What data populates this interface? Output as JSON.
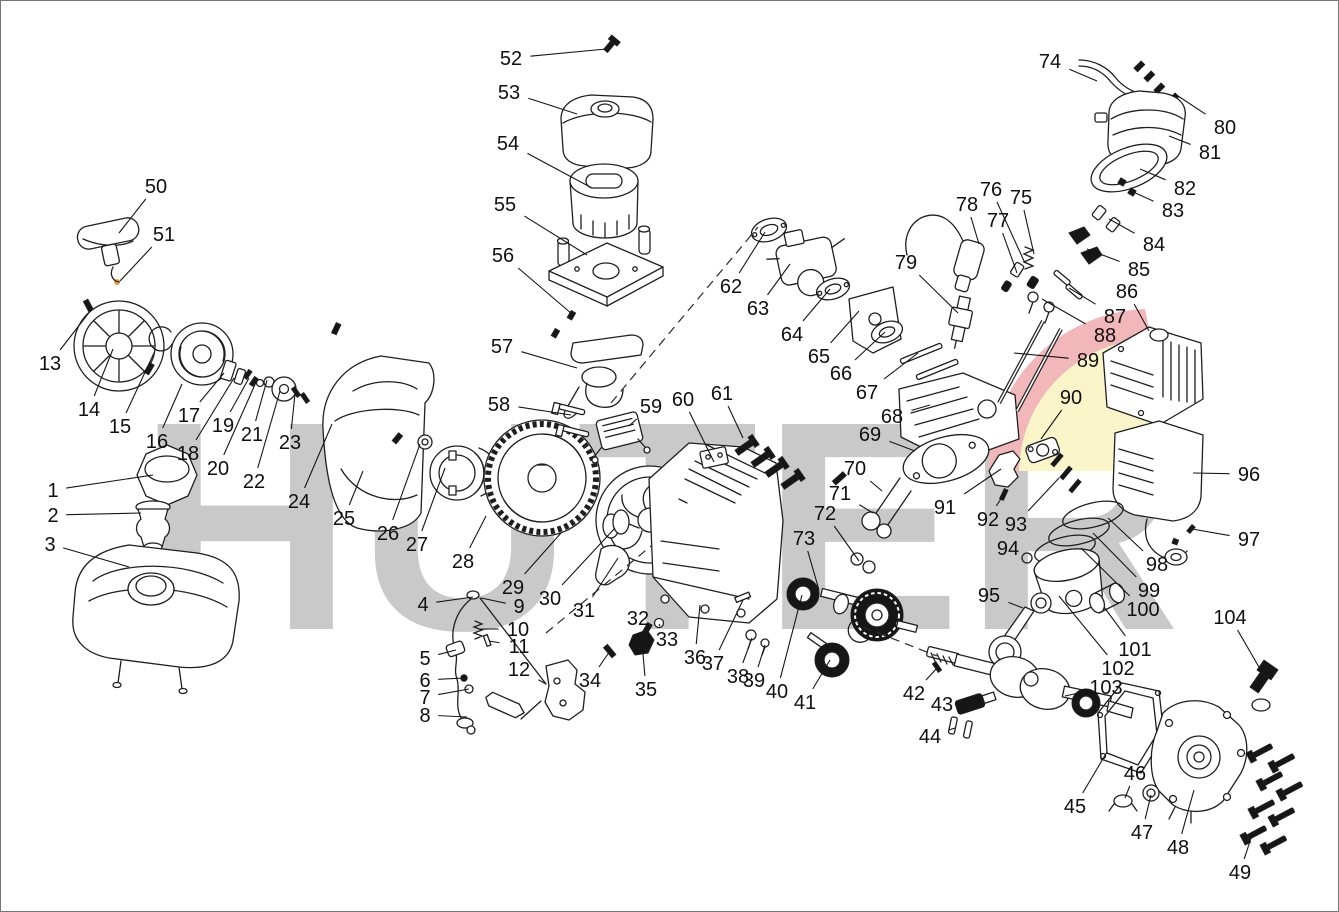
{
  "diagram": {
    "type": "exploded-parts-diagram",
    "subject": "gasoline-engine",
    "canvas": {
      "width": 1339,
      "height": 912
    },
    "watermark": {
      "text": "HUTER",
      "gray_color": "#c9c9c9",
      "red_color": "#f2b7b9",
      "yellow_color": "#faf5c9",
      "accent_dot_color": "#e8a33d"
    },
    "label_color": "#101010",
    "part_count": 104,
    "dashed_axes": [
      {
        "x1": 610,
        "y1": 402,
        "x2": 757,
        "y2": 226
      },
      {
        "x1": 545,
        "y1": 632,
        "x2": 650,
        "y2": 545
      },
      {
        "x1": 862,
        "y1": 626,
        "x2": 936,
        "y2": 655
      }
    ],
    "parts": [
      {
        "n": "1",
        "x": 52,
        "y": 489,
        "ex": 152,
        "ey": 474
      },
      {
        "n": "2",
        "x": 52,
        "y": 514,
        "ex": 140,
        "ey": 512
      },
      {
        "n": "3",
        "x": 49,
        "y": 543,
        "ex": 128,
        "ey": 566
      },
      {
        "n": "4",
        "x": 422,
        "y": 603,
        "ex": 472,
        "ey": 596
      },
      {
        "n": "5",
        "x": 424,
        "y": 657,
        "ex": 455,
        "ey": 649
      },
      {
        "n": "6",
        "x": 424,
        "y": 679,
        "ex": 463,
        "ey": 677
      },
      {
        "n": "7",
        "x": 424,
        "y": 696,
        "ex": 468,
        "ey": 688
      },
      {
        "n": "8",
        "x": 424,
        "y": 714,
        "ex": 466,
        "ey": 716
      },
      {
        "n": "9",
        "x": 518,
        "y": 605,
        "ex": 480,
        "ey": 597
      },
      {
        "n": "10",
        "x": 517,
        "y": 628,
        "ex": 478,
        "ey": 628
      },
      {
        "n": "11",
        "x": 518,
        "y": 645,
        "ex": 488,
        "ey": 640
      },
      {
        "n": "12",
        "x": 518,
        "y": 668,
        "ex": 545,
        "ey": 683
      },
      {
        "n": "13",
        "x": 49,
        "y": 362,
        "ex": 90,
        "ey": 309
      },
      {
        "n": "14",
        "x": 88,
        "y": 408,
        "ex": 112,
        "ey": 348
      },
      {
        "n": "15",
        "x": 119,
        "y": 425,
        "ex": 153,
        "ey": 352
      },
      {
        "n": "16",
        "x": 156,
        "y": 440,
        "ex": 181,
        "ey": 383
      },
      {
        "n": "17",
        "x": 188,
        "y": 414,
        "ex": 223,
        "ey": 372
      },
      {
        "n": "18",
        "x": 187,
        "y": 452,
        "ex": 233,
        "ey": 377
      },
      {
        "n": "19",
        "x": 222,
        "y": 424,
        "ex": 248,
        "ey": 377
      },
      {
        "n": "20",
        "x": 217,
        "y": 467,
        "ex": 256,
        "ey": 379
      },
      {
        "n": "21",
        "x": 251,
        "y": 433,
        "ex": 266,
        "ey": 379
      },
      {
        "n": "22",
        "x": 253,
        "y": 480,
        "ex": 279,
        "ey": 390
      },
      {
        "n": "23",
        "x": 289,
        "y": 441,
        "ex": 294,
        "ey": 393
      },
      {
        "n": "24",
        "x": 298,
        "y": 500,
        "ex": 331,
        "ey": 423
      },
      {
        "n": "25",
        "x": 343,
        "y": 517,
        "ex": 362,
        "ey": 470
      },
      {
        "n": "26",
        "x": 387,
        "y": 532,
        "ex": 419,
        "ey": 443
      },
      {
        "n": "27",
        "x": 416,
        "y": 543,
        "ex": 444,
        "ey": 467
      },
      {
        "n": "28",
        "x": 462,
        "y": 560,
        "ex": 485,
        "ey": 515
      },
      {
        "n": "29",
        "x": 512,
        "y": 586,
        "ex": 560,
        "ey": 532
      },
      {
        "n": "30",
        "x": 549,
        "y": 597,
        "ex": 614,
        "ey": 527
      },
      {
        "n": "31",
        "x": 583,
        "y": 609,
        "ex": 617,
        "ey": 557
      },
      {
        "n": "32",
        "x": 637,
        "y": 617,
        "ex": 646,
        "ey": 628
      },
      {
        "n": "33",
        "x": 666,
        "y": 638,
        "ex": 658,
        "ey": 623
      },
      {
        "n": "34",
        "x": 589,
        "y": 679,
        "ex": 609,
        "ey": 650
      },
      {
        "n": "35",
        "x": 645,
        "y": 688,
        "ex": 641,
        "ey": 641
      },
      {
        "n": "36",
        "x": 694,
        "y": 656,
        "ex": 699,
        "ey": 604
      },
      {
        "n": "37",
        "x": 712,
        "y": 662,
        "ex": 742,
        "ey": 599
      },
      {
        "n": "38",
        "x": 737,
        "y": 675,
        "ex": 751,
        "ey": 637
      },
      {
        "n": "39",
        "x": 753,
        "y": 679,
        "ex": 764,
        "ey": 644
      },
      {
        "n": "40",
        "x": 776,
        "y": 690,
        "ex": 801,
        "ey": 594
      },
      {
        "n": "41",
        "x": 804,
        "y": 701,
        "ex": 829,
        "ey": 659
      },
      {
        "n": "42",
        "x": 913,
        "y": 692,
        "ex": 936,
        "ey": 667
      },
      {
        "n": "43",
        "x": 941,
        "y": 703,
        "ex": 959,
        "ey": 697
      },
      {
        "n": "44",
        "x": 929,
        "y": 735,
        "ex": 954,
        "ey": 727
      },
      {
        "n": "45",
        "x": 1074,
        "y": 805,
        "ex": 1106,
        "ey": 751
      },
      {
        "n": "46",
        "x": 1134,
        "y": 772,
        "ex": 1124,
        "ey": 797
      },
      {
        "n": "47",
        "x": 1141,
        "y": 831,
        "ex": 1150,
        "ey": 794
      },
      {
        "n": "48",
        "x": 1177,
        "y": 846,
        "ex": 1193,
        "ey": 789
      },
      {
        "n": "49",
        "x": 1239,
        "y": 871,
        "ex": 1251,
        "ey": 834
      },
      {
        "n": "50",
        "x": 155,
        "y": 185,
        "ex": 118,
        "ey": 232
      },
      {
        "n": "51",
        "x": 163,
        "y": 233,
        "ex": 119,
        "ey": 280
      },
      {
        "n": "52",
        "x": 510,
        "y": 57,
        "ex": 605,
        "ey": 48
      },
      {
        "n": "53",
        "x": 508,
        "y": 91,
        "ex": 576,
        "ey": 113
      },
      {
        "n": "54",
        "x": 507,
        "y": 142,
        "ex": 591,
        "ey": 187
      },
      {
        "n": "55",
        "x": 504,
        "y": 203,
        "ex": 586,
        "ey": 254
      },
      {
        "n": "56",
        "x": 502,
        "y": 254,
        "ex": 571,
        "ey": 313
      },
      {
        "n": "57",
        "x": 501,
        "y": 345,
        "ex": 576,
        "ey": 367
      },
      {
        "n": "58",
        "x": 498,
        "y": 403,
        "ex": 570,
        "ey": 414
      },
      {
        "n": "59",
        "x": 650,
        "y": 405,
        "ex": 628,
        "ey": 425
      },
      {
        "n": "60",
        "x": 682,
        "y": 398,
        "ex": 713,
        "ey": 461
      },
      {
        "n": "61",
        "x": 721,
        "y": 392,
        "ex": 742,
        "ey": 437
      },
      {
        "n": "62",
        "x": 730,
        "y": 285,
        "ex": 764,
        "ey": 231
      },
      {
        "n": "63",
        "x": 757,
        "y": 307,
        "ex": 789,
        "ey": 263
      },
      {
        "n": "64",
        "x": 791,
        "y": 333,
        "ex": 829,
        "ey": 288
      },
      {
        "n": "65",
        "x": 818,
        "y": 355,
        "ex": 858,
        "ey": 310
      },
      {
        "n": "66",
        "x": 840,
        "y": 372,
        "ex": 884,
        "ey": 331
      },
      {
        "n": "67",
        "x": 866,
        "y": 391,
        "ex": 917,
        "ey": 352
      },
      {
        "n": "68",
        "x": 891,
        "y": 415,
        "ex": 929,
        "ey": 404
      },
      {
        "n": "69",
        "x": 869,
        "y": 433,
        "ex": 914,
        "ey": 450
      },
      {
        "n": "70",
        "x": 854,
        "y": 467,
        "ex": 881,
        "ey": 490
      },
      {
        "n": "71",
        "x": 839,
        "y": 492,
        "ex": 872,
        "ey": 512
      },
      {
        "n": "72",
        "x": 824,
        "y": 512,
        "ex": 858,
        "ey": 560
      },
      {
        "n": "73",
        "x": 803,
        "y": 537,
        "ex": 818,
        "ey": 589
      },
      {
        "n": "74",
        "x": 1049,
        "y": 60,
        "ex": 1096,
        "ey": 80
      },
      {
        "n": "75",
        "x": 1020,
        "y": 196,
        "ex": 1033,
        "ey": 253
      },
      {
        "n": "76",
        "x": 990,
        "y": 188,
        "ex": 1024,
        "ey": 262
      },
      {
        "n": "77",
        "x": 997,
        "y": 219,
        "ex": 1016,
        "ey": 272
      },
      {
        "n": "78",
        "x": 966,
        "y": 203,
        "ex": 978,
        "ey": 243
      },
      {
        "n": "79",
        "x": 905,
        "y": 261,
        "ex": 957,
        "ey": 312
      },
      {
        "n": "80",
        "x": 1224,
        "y": 126,
        "ex": 1174,
        "ey": 93
      },
      {
        "n": "81",
        "x": 1209,
        "y": 151,
        "ex": 1168,
        "ey": 135
      },
      {
        "n": "82",
        "x": 1184,
        "y": 187,
        "ex": 1139,
        "ey": 168
      },
      {
        "n": "83",
        "x": 1172,
        "y": 209,
        "ex": 1130,
        "ey": 190
      },
      {
        "n": "84",
        "x": 1153,
        "y": 243,
        "ex": 1108,
        "ey": 218
      },
      {
        "n": "85",
        "x": 1138,
        "y": 268,
        "ex": 1086,
        "ey": 248
      },
      {
        "n": "86",
        "x": 1126,
        "y": 290,
        "ex": 1148,
        "ey": 330
      },
      {
        "n": "87",
        "x": 1114,
        "y": 315,
        "ex": 1068,
        "ey": 287
      },
      {
        "n": "88",
        "x": 1104,
        "y": 334,
        "ex": 1041,
        "ey": 298
      },
      {
        "n": "89",
        "x": 1087,
        "y": 359,
        "ex": 1013,
        "ey": 352
      },
      {
        "n": "90",
        "x": 1070,
        "y": 396,
        "ex": 1040,
        "ey": 438
      },
      {
        "n": "91",
        "x": 944,
        "y": 506,
        "ex": 1000,
        "ey": 468
      },
      {
        "n": "92",
        "x": 987,
        "y": 518,
        "ex": 1003,
        "ey": 493
      },
      {
        "n": "93",
        "x": 1015,
        "y": 523,
        "ex": 1058,
        "ey": 477
      },
      {
        "n": "94",
        "x": 1007,
        "y": 547,
        "ex": 1026,
        "ey": 557
      },
      {
        "n": "95",
        "x": 988,
        "y": 594,
        "ex": 1022,
        "ey": 607
      },
      {
        "n": "96",
        "x": 1248,
        "y": 473,
        "ex": 1192,
        "ey": 472
      },
      {
        "n": "97",
        "x": 1248,
        "y": 538,
        "ex": 1191,
        "ey": 528
      },
      {
        "n": "98",
        "x": 1156,
        "y": 563,
        "ex": 1107,
        "ey": 517
      },
      {
        "n": "99",
        "x": 1148,
        "y": 589,
        "ex": 1092,
        "ey": 532
      },
      {
        "n": "100",
        "x": 1142,
        "y": 608,
        "ex": 1080,
        "ey": 547
      },
      {
        "n": "101",
        "x": 1134,
        "y": 648,
        "ex": 1103,
        "ey": 606
      },
      {
        "n": "102",
        "x": 1117,
        "y": 667,
        "ex": 1058,
        "ey": 595
      },
      {
        "n": "103",
        "x": 1105,
        "y": 686,
        "ex": 1064,
        "ey": 695
      },
      {
        "n": "104",
        "x": 1229,
        "y": 616,
        "ex": 1262,
        "ey": 673
      }
    ]
  }
}
